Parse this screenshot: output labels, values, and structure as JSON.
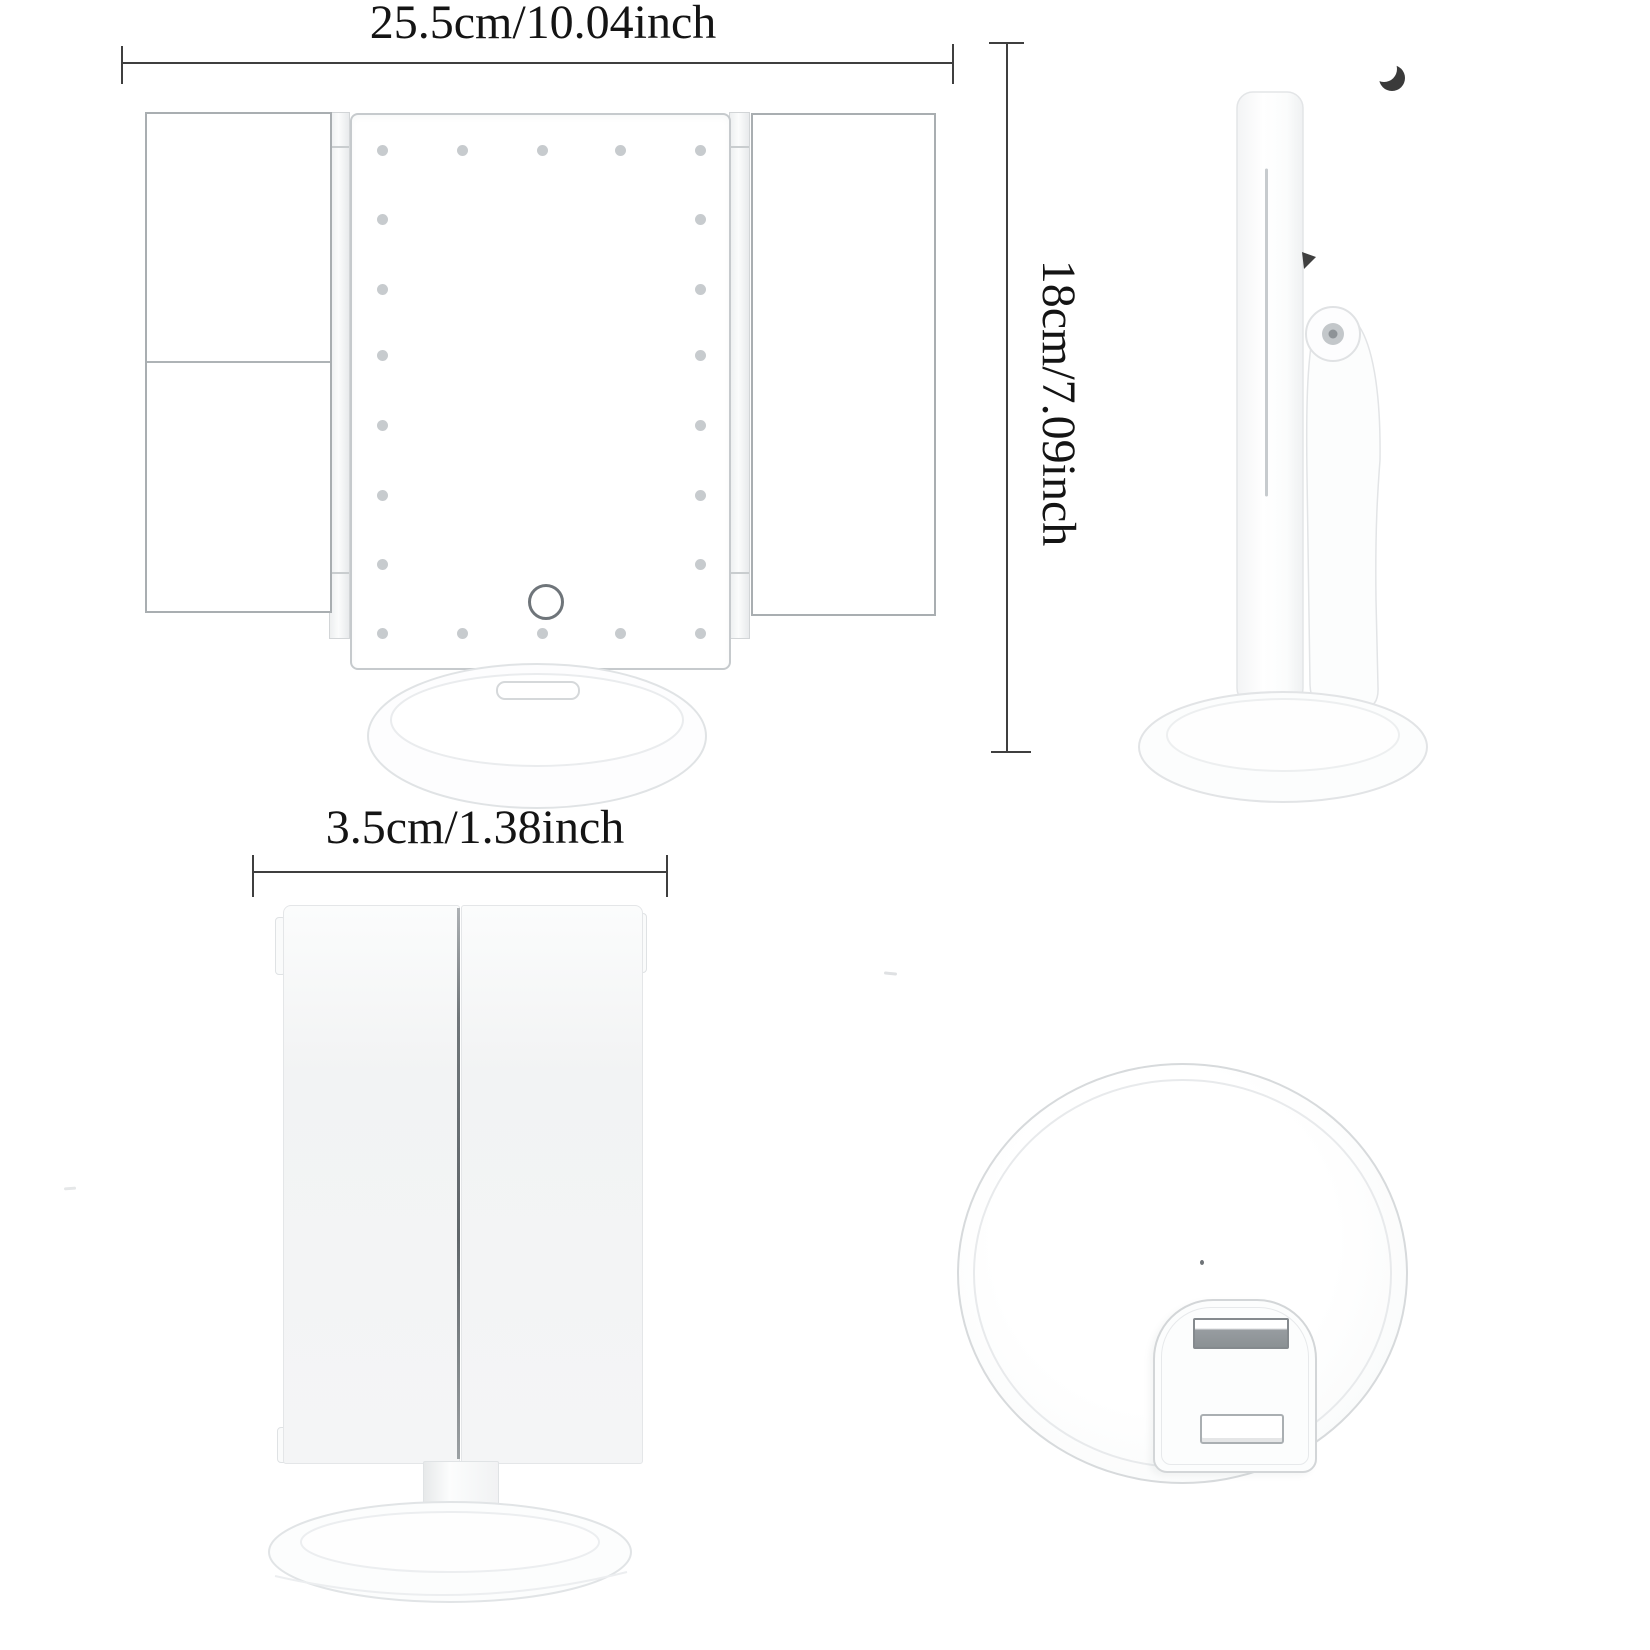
{
  "image": {
    "kind": "product-dimension-diagram",
    "background": "#ffffff"
  },
  "annotations": {
    "width": "25.5cm/10.04inch",
    "height": "18cm/7.09inch",
    "depth": "3.5cm/1.38inch"
  },
  "product": {
    "name": "trifold-led-vanity-mirror",
    "led_count": 22,
    "views": [
      "front-open",
      "side",
      "front-folded",
      "base-back"
    ]
  },
  "colors": {
    "bg": "#ffffff",
    "text": "#141414",
    "dim_line": "#3f3f3f",
    "body": "#ffffff",
    "outline_mid": "#a9aeb1",
    "outline_light": "#dfe2e4",
    "led": "#c7cbce",
    "seam_dark": "#60666a"
  }
}
